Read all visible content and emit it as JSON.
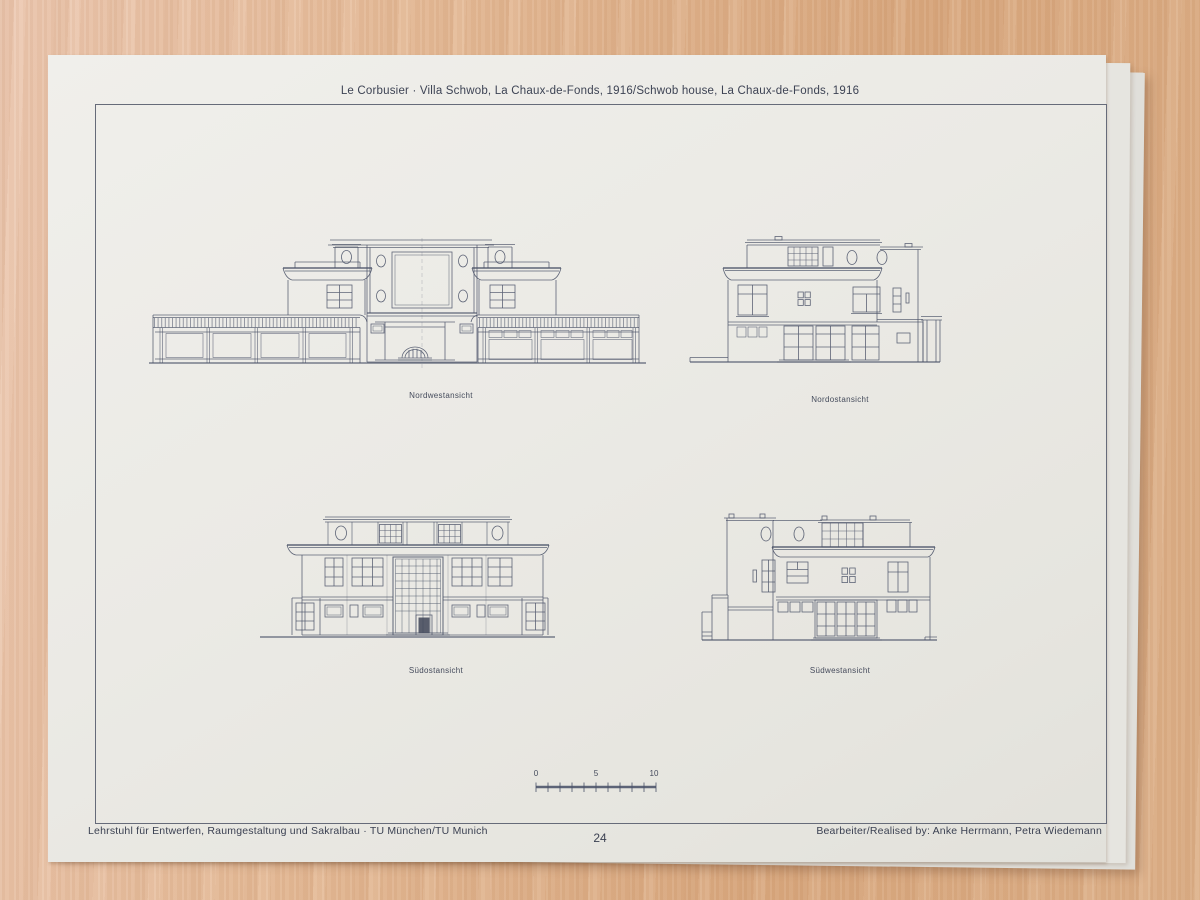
{
  "page": {
    "title": "Le Corbusier · Villa Schwob, La Chaux-de-Fonds, 1916/Schwob house, La Chaux-de-Fonds, 1916",
    "page_number": "24",
    "footer_left": "Lehrstuhl für Entwerfen, Raumgestaltung und Sakralbau · TU München/TU Munich",
    "footer_right": "Bearbeiter/Realised by: Anke Herrmann, Petra Wiedemann"
  },
  "figures": [
    {
      "caption": "Nordwestansicht"
    },
    {
      "caption": "Nordostansicht"
    },
    {
      "caption": "Südostansicht"
    },
    {
      "caption": "Südwestansicht"
    }
  ],
  "scale_bar": {
    "t0": "0",
    "t5": "5",
    "t10": "10"
  },
  "colors": {
    "paper": "#ebeae5",
    "wood": "#dcab82",
    "ink": "#4a5268"
  }
}
